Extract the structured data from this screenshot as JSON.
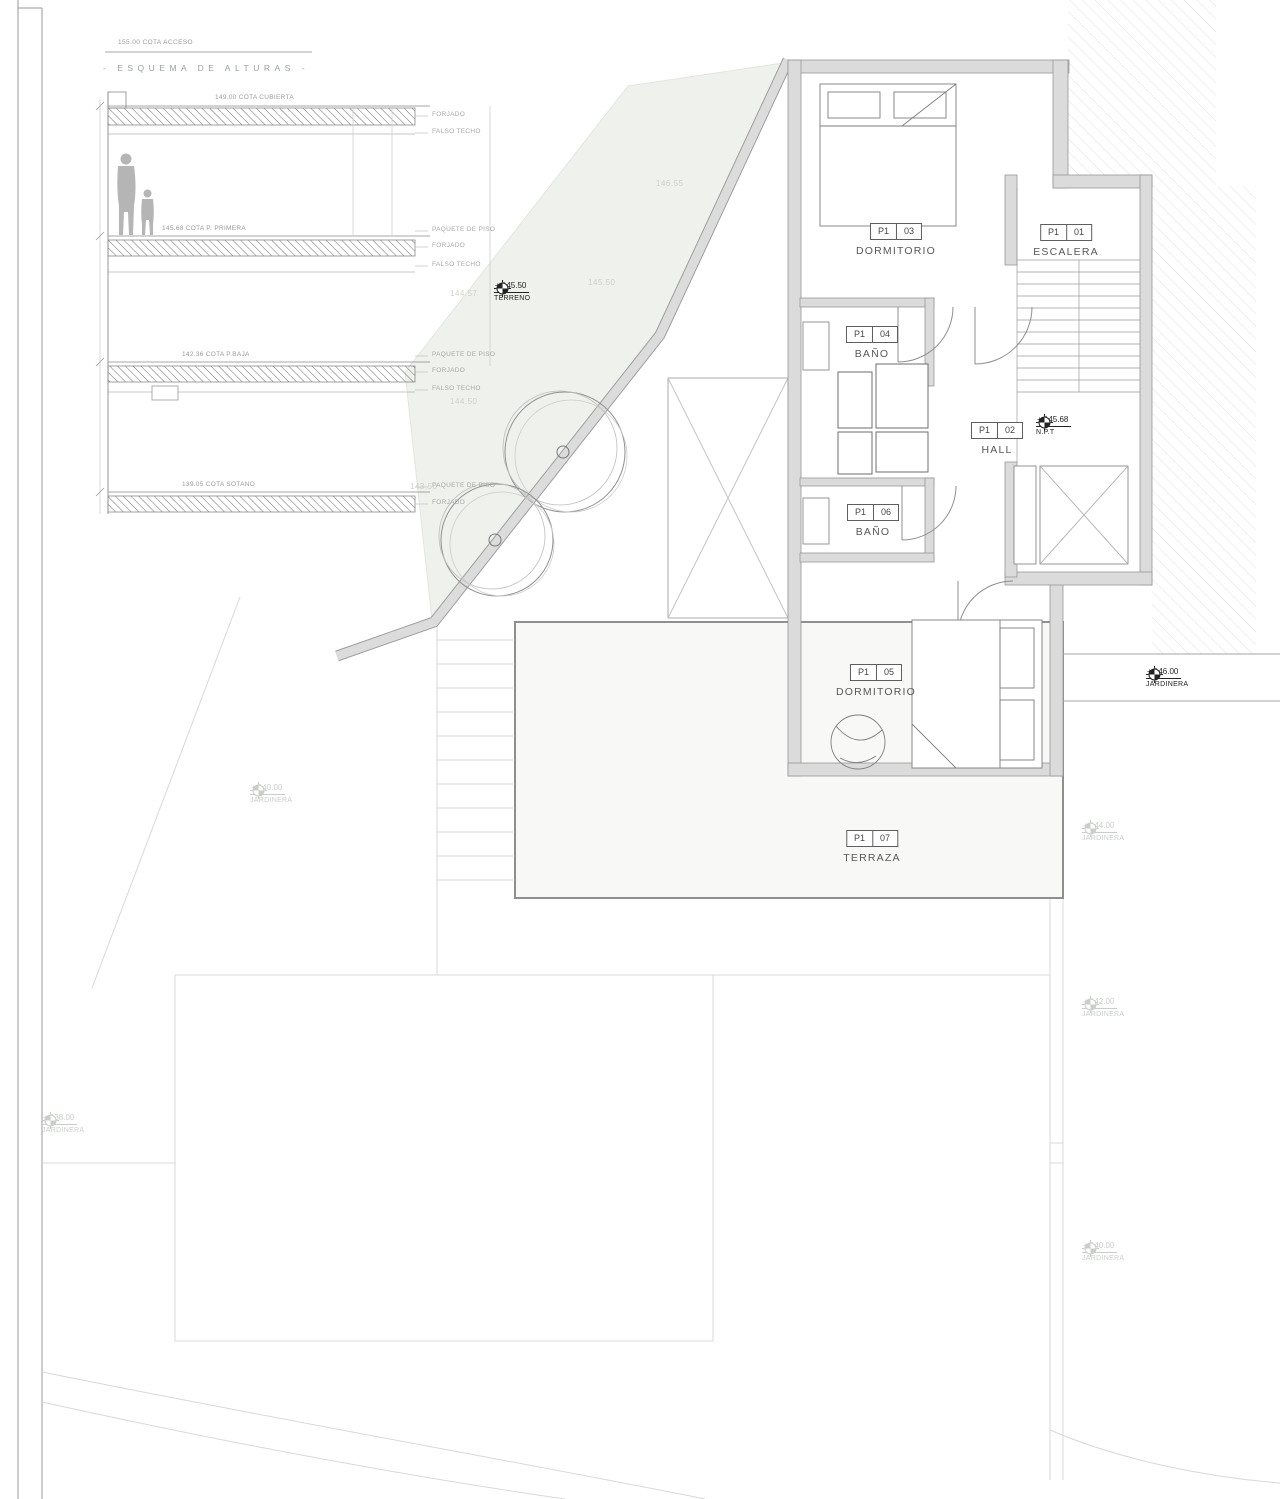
{
  "schema": {
    "access_label": "155.00 COTA ACCESO",
    "title": "- ESQUEMA DE ALTURAS -",
    "levels": [
      {
        "cota": "149.00 COTA CUBIERTA",
        "l1": "FORJADO",
        "l2": "FALSO TECHO"
      },
      {
        "cota": "145.68 COTA P. PRIMERA",
        "l1": "PAQUETE DE PISO",
        "l2": "FORJADO",
        "l3": "FALSO TECHO"
      },
      {
        "cota": "142.36 COTA P.BAJA",
        "l1": "PAQUETE DE PISO",
        "l2": "FORJADO",
        "l3": "FALSO TECHO"
      },
      {
        "cota": "139.05 COTA SOTANO",
        "l1": "PAQUETE DE PISO",
        "l2": "FORJADO"
      }
    ]
  },
  "rooms": [
    {
      "prefix": "P1",
      "num": "03",
      "name": "DORMITORIO"
    },
    {
      "prefix": "P1",
      "num": "01",
      "name": "ESCALERA"
    },
    {
      "prefix": "P1",
      "num": "04",
      "name": "BAÑO"
    },
    {
      "prefix": "P1",
      "num": "02",
      "name": "HALL"
    },
    {
      "prefix": "P1",
      "num": "06",
      "name": "BAÑO"
    },
    {
      "prefix": "P1",
      "num": "05",
      "name": "DORMITORIO"
    },
    {
      "prefix": "P1",
      "num": "07",
      "name": "TERRAZA"
    }
  ],
  "markers": {
    "terreno": {
      "value": "+ 145.50",
      "label": "TERRENO"
    },
    "npt": {
      "value": "+ 145.68",
      "label": "N.P.T"
    },
    "jardinera_146": {
      "value": "+ 146.00",
      "label": "JARDINERA"
    },
    "jardinera_144": {
      "value": "+ 144.00",
      "label": "JARDINERA"
    },
    "jardinera_142": {
      "value": "+ 142.00",
      "label": "JARDINERA"
    },
    "jardinera_140_right": {
      "value": "+ 140.00",
      "label": "JARDINERA"
    },
    "jardinera_140_left": {
      "value": "+ 140.00",
      "label": "JARDINERA"
    },
    "jardinera_138": {
      "value": "+ 138.00",
      "label": "JARDINERA"
    }
  },
  "contours": {
    "c1": "146.55",
    "c2": "145.50",
    "c3": "144.57",
    "c4": "144.50",
    "c5": "143.50"
  },
  "colors": {
    "wall_fill": "#dbdbdb",
    "terrain_fill": "#eff1ec",
    "faint": "#d8d8d8",
    "text_light": "#c9cec9"
  }
}
